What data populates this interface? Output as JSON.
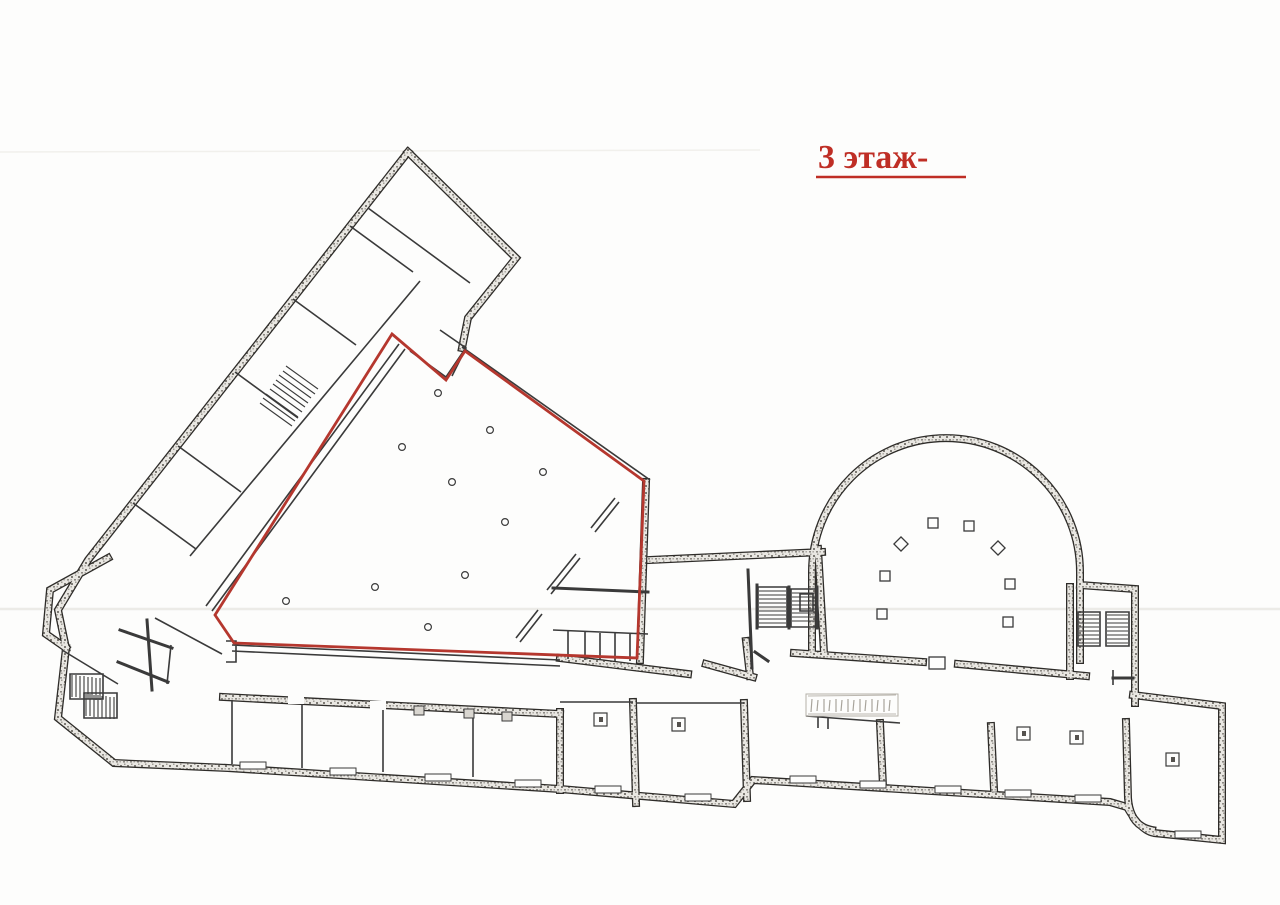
{
  "page": {
    "background": "#fdfdfc"
  },
  "title": {
    "text": "3 этаж-",
    "color": "#bf2e25"
  },
  "plan": {
    "red_outline_color": "#b5372e",
    "wall_ink_color": "#2e2c29"
  }
}
